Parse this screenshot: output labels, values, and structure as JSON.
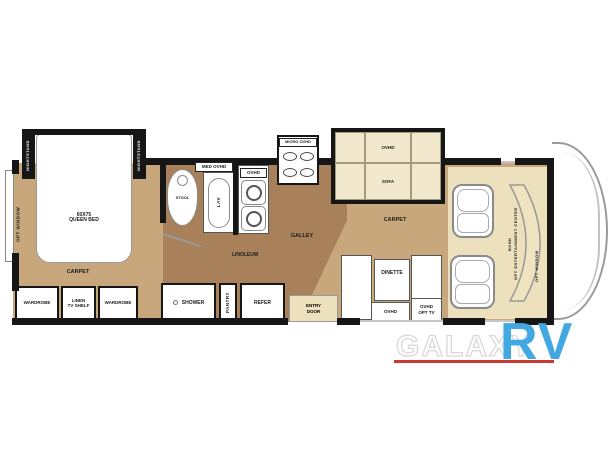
{
  "plan": {
    "bedroom": {
      "rear_window": "OPT WINDOW",
      "nightstand": "NIGHTSTAND",
      "bed_size": "60x75",
      "bed_type": "QUEEN BED",
      "carpet": "CARPET",
      "wardrobe_left": "WARDROBE",
      "linen_line1": "LINEN",
      "linen_line2": "TV SHELF",
      "wardrobe_right": "WARDROBE"
    },
    "bath": {
      "stool": "STOOL",
      "med_ovhd": "MED OVHD",
      "lav": "LAV",
      "shower": "SHOWER"
    },
    "galley": {
      "ovhd": "OVHD",
      "micro_ovhd": "MICRO OVHD",
      "name": "GALLEY",
      "linoleum": "LINOLEUM",
      "pantry": "PANTRY",
      "refer": "REFER",
      "entry_line1": "ENTRY",
      "entry_line2": "DOOR"
    },
    "living": {
      "sofa_ovhd": "OVHD",
      "sofa": "SOFA",
      "carpet": "CARPET",
      "dinette": "DINETTE",
      "dinette_ovhd": "OVHD",
      "opt_tv_line1": "OVHD",
      "opt_tv_line2": "OPT TV"
    },
    "cab": {
      "bunk": "BUNK",
      "ent_center": "OPT ENTERTAINMENT CENTER",
      "opt_window": "OPT WINDOW"
    }
  },
  "watermark": {
    "brand": "GALAXY",
    "suffix": "RV",
    "suffix_color": "#42a8e2",
    "underline_color": "#cb3a31"
  },
  "colors": {
    "carpet": "#c8a77c",
    "linoleum": "#a8805a",
    "cream": "#ece0bd",
    "wall": "#161616"
  }
}
